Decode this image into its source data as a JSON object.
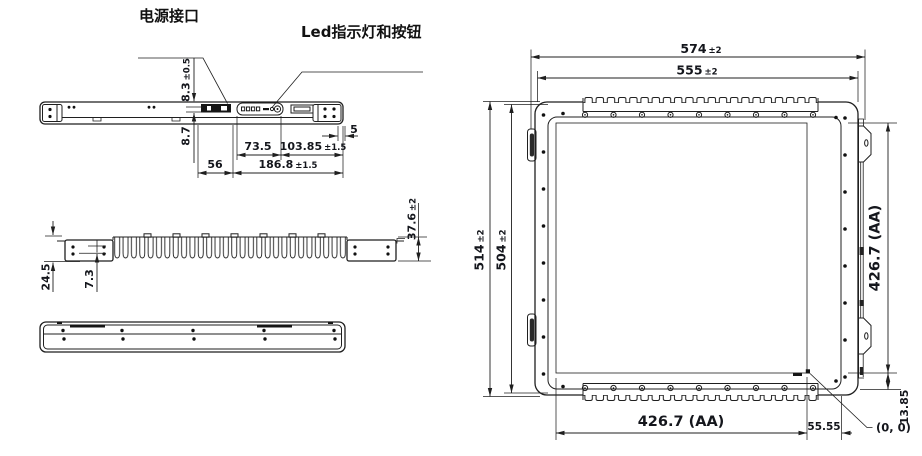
{
  "labels": {
    "power_port": "电源接口",
    "led_button": "Led指示灯和按钮"
  },
  "top_view_dims": {
    "d83": {
      "v": "8.3",
      "t": "±0.5"
    },
    "d87": {
      "v": "8.7"
    },
    "d5": {
      "v": "5"
    },
    "d735": {
      "v": "73.5"
    },
    "d10385": {
      "v": "103.85",
      "t": "±1.5"
    },
    "d56": {
      "v": "56"
    },
    "d1868": {
      "v": "186.8",
      "t": "±1.5"
    }
  },
  "side_view_dims": {
    "d245": {
      "v": "24.5"
    },
    "d73": {
      "v": "7.3"
    },
    "d376": {
      "v": "37.6",
      "t": "±2"
    }
  },
  "front_view_dims": {
    "d574": {
      "v": "574",
      "t": "±2"
    },
    "d555": {
      "v": "555",
      "t": "±2"
    },
    "d514": {
      "v": "514",
      "t": "±2"
    },
    "d504": {
      "v": "504",
      "t": "±2"
    },
    "aa_width": {
      "v": "426.7 (AA)"
    },
    "aa_height": {
      "v": "426.7 (AA)"
    },
    "d5555": {
      "v": "55.55"
    },
    "d1385": {
      "v": "13.85"
    },
    "origin": {
      "v": "(0, 0)"
    }
  }
}
